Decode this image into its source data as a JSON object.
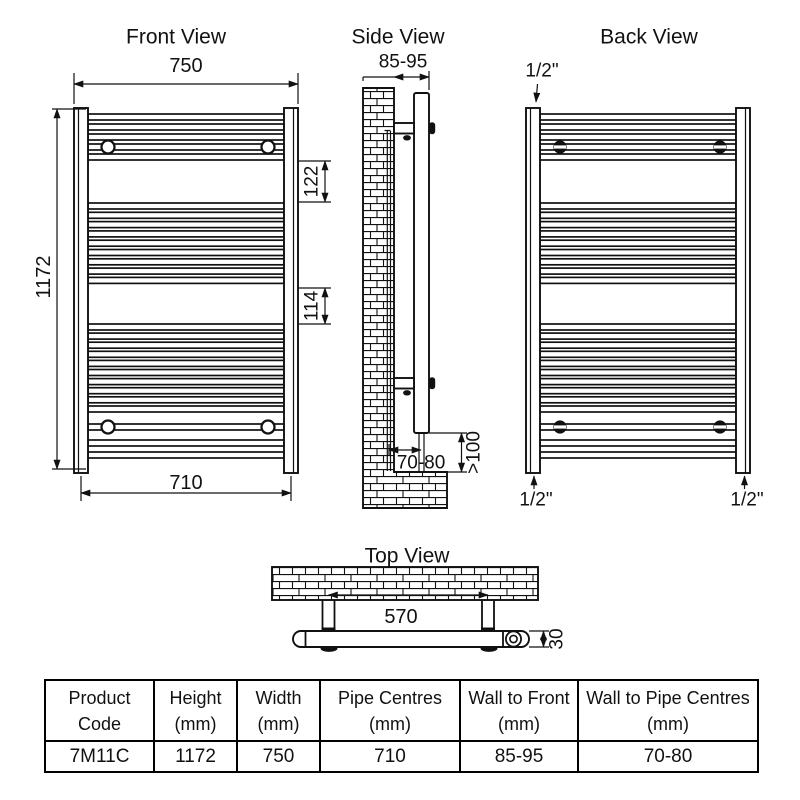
{
  "front_view": {
    "title": "Front View",
    "overall_width": "750",
    "overall_height": "1172",
    "upper_gap": "122",
    "middle_gap": "114",
    "pipe_centres": "710"
  },
  "side_view": {
    "title": "Side View",
    "wall_to_front": "85-95",
    "wall_to_pipe_centres": "70-80",
    "min_floor_clearance": ">100"
  },
  "back_view": {
    "title": "Back View",
    "connection_top_left": "1/2\"",
    "connection_bottom_left": "1/2\"",
    "connection_bottom_right": "1/2\""
  },
  "top_view": {
    "title": "Top View",
    "bracket_centres": "570",
    "tube_depth": "30"
  },
  "spec_table": {
    "headers": [
      {
        "line1": "Product",
        "line2": "Code"
      },
      {
        "line1": "Height",
        "line2": "(mm)"
      },
      {
        "line1": "Width",
        "line2": "(mm)"
      },
      {
        "line1": "Pipe Centres",
        "line2": "(mm)"
      },
      {
        "line1": "Wall to Front",
        "line2": "(mm)"
      },
      {
        "line1": "Wall to Pipe Centres",
        "line2": "(mm)"
      }
    ],
    "row": {
      "product_code": "7M11C",
      "height": "1172",
      "width": "750",
      "pipe_centres": "710",
      "wall_to_front": "85-95",
      "wall_to_pipe_centres": "70-80"
    }
  }
}
